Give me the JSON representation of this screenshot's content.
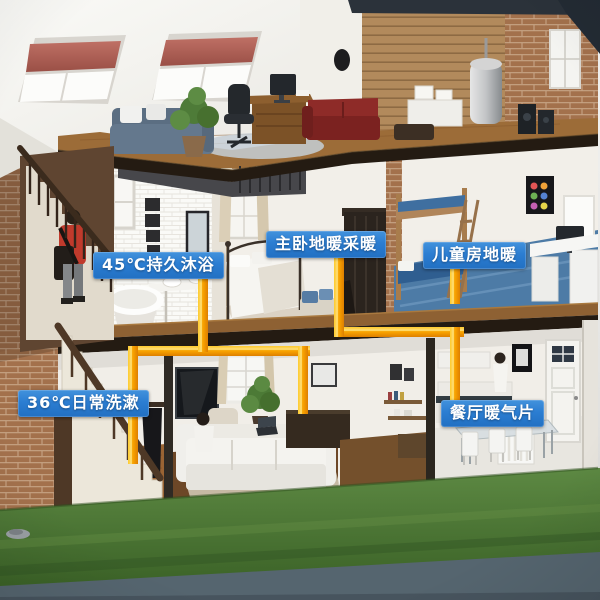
{
  "annotations": {
    "labels": [
      {
        "id": "shower-45c",
        "text": "45℃持久沐浴"
      },
      {
        "id": "master-bedroom-floor-heating",
        "text": "主卧地暖采暖"
      },
      {
        "id": "children-room-floor-heating",
        "text": "儿童房地暖"
      },
      {
        "id": "daily-washing-36c",
        "text": "36℃日常洗漱"
      },
      {
        "id": "dining-room-radiator",
        "text": "餐厅暖气片"
      }
    ],
    "label_style": {
      "background": "#2b7dd2",
      "text_color": "#ffffff"
    }
  },
  "colors": {
    "pipe_orange": "#f7a000",
    "pipe_highlight": "#ffd84d",
    "grass_green": "#4e7b36",
    "pavement_gray": "#55656f",
    "skylight_blind_red": "#b05e55",
    "label_blue": "#2b7dd2"
  }
}
